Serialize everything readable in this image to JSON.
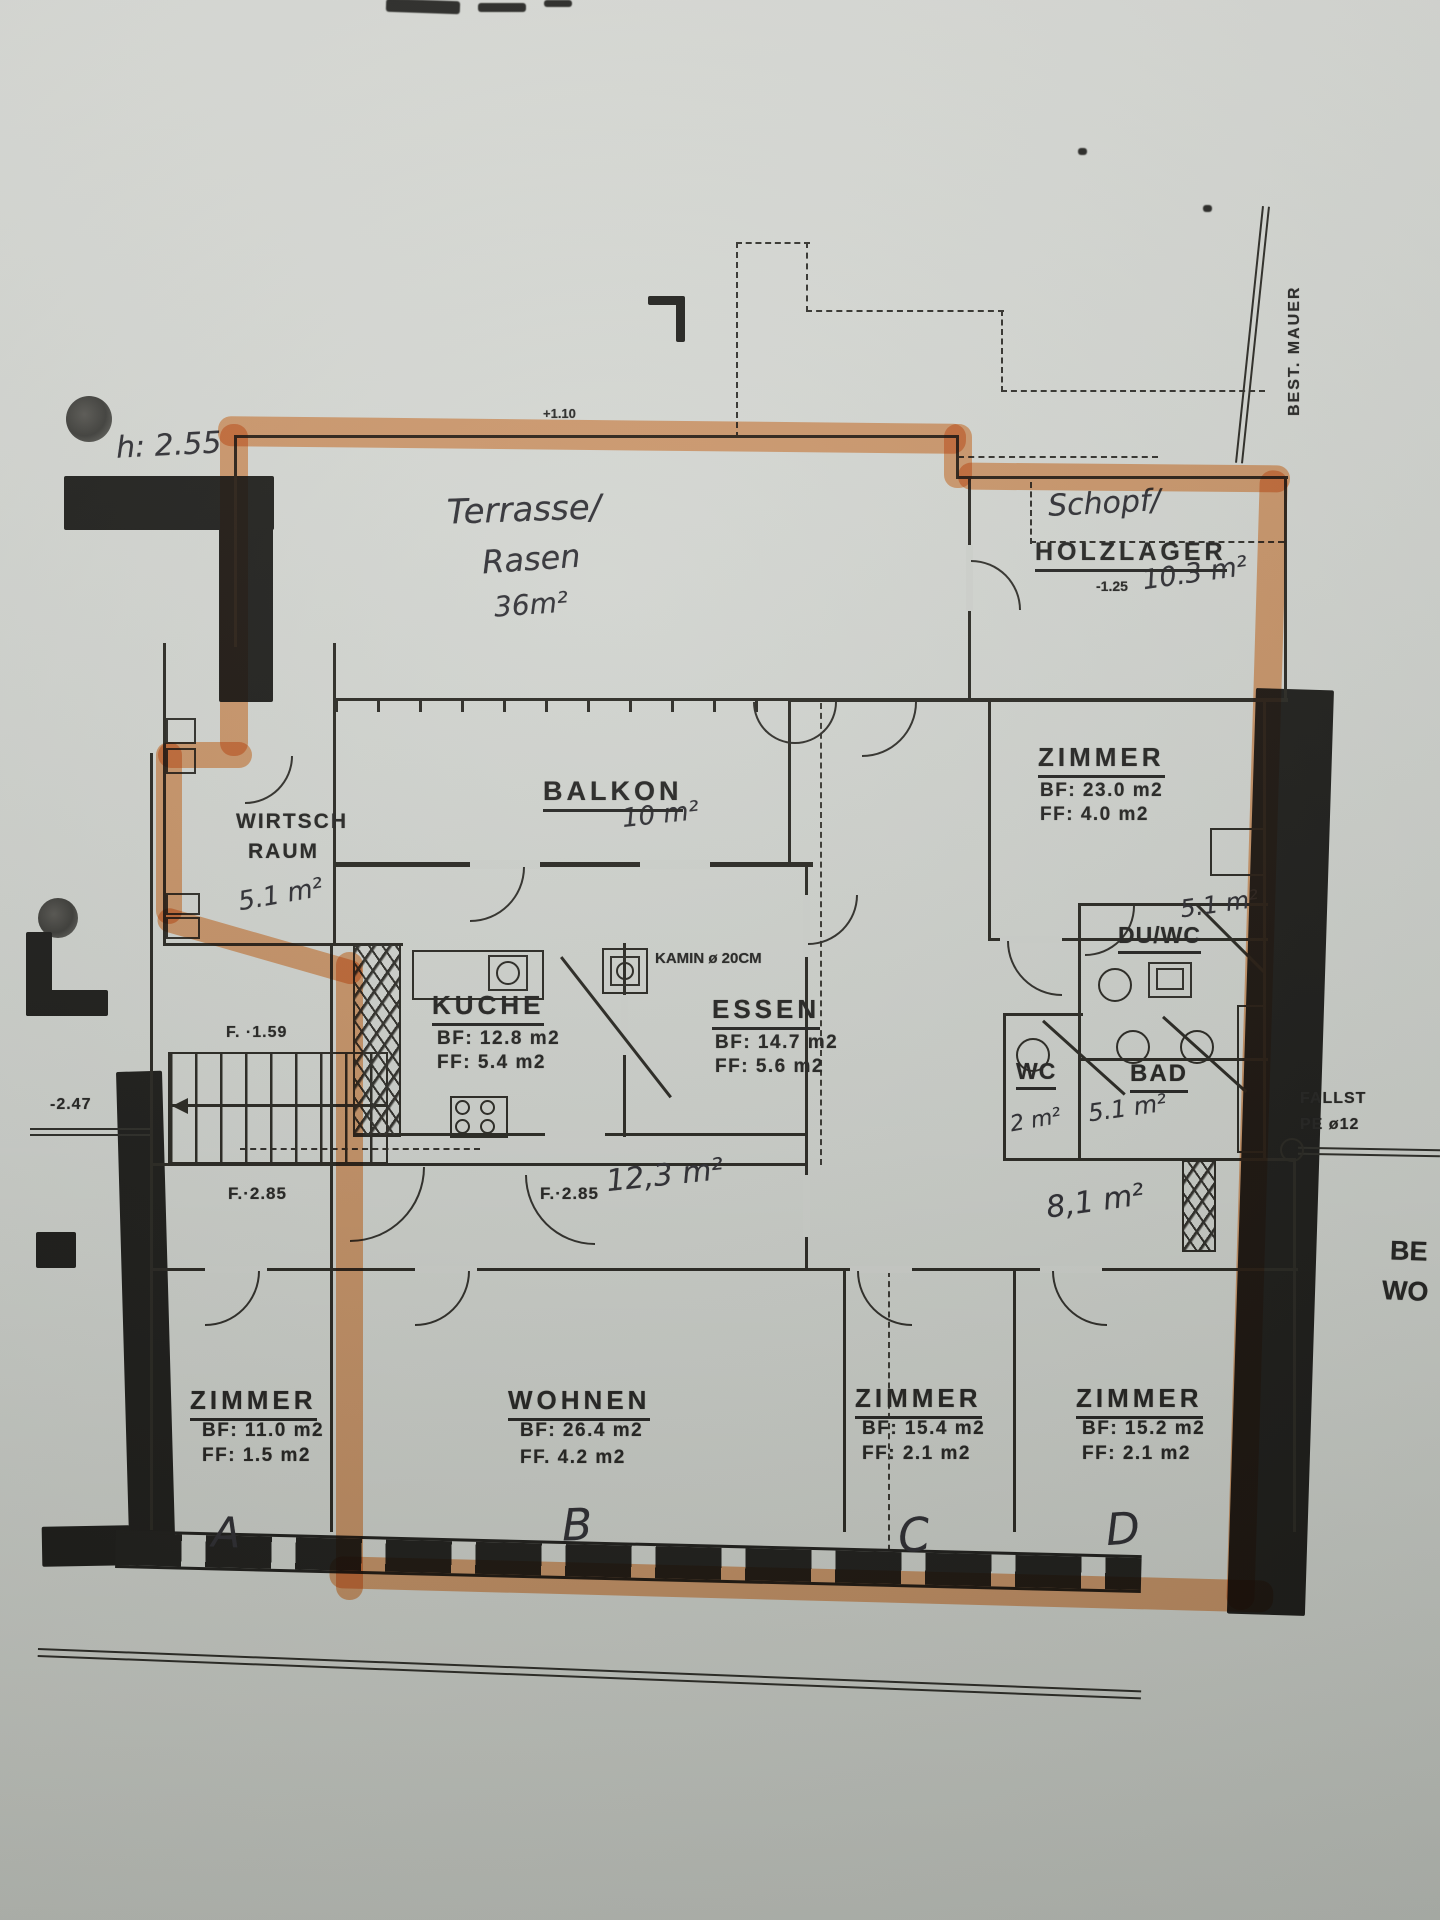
{
  "annotations": {
    "height_note": "h: 2.55",
    "level_top": "+1.10",
    "terrace_1": "Terrasse/",
    "terrace_2": "Rasen",
    "terrace_area": "36m²",
    "schopf": "Schopf/",
    "holzlager": "HOLZLAGER",
    "holzlager_level": "-1.25",
    "holzlager_area": "10.3 m²",
    "best_mauer": "BEST. MAUER",
    "balkon": "BALKON",
    "balkon_area": "10 m²",
    "wirtsch_1": "WIRTSCH",
    "wirtsch_2": "RAUM",
    "wirtsch_area": "5.1 m²",
    "kamin": "KAMIN ø 20CM",
    "level_stair": "F. ·1.59",
    "level_left": "-2.47",
    "f285_left": "F.·2.85",
    "f285_mid": "F.·2.85",
    "hall_area_mid": "12,3 m²",
    "hall_area_right": "8,1 m²",
    "duwc_area": "5.1 m²",
    "wc_area": "2 m²",
    "bad_area": "5.1 m²",
    "fallstrang_1": "FALLST",
    "fallstrang_2": "PE ø12",
    "edge_1": "BE",
    "edge_2": "WO"
  },
  "rooms": {
    "zimmer_ne": {
      "name": "ZIMMER",
      "bf": "BF: 23.0 m2",
      "ff": "FF: 4.0 m2"
    },
    "kueche": {
      "name": "KUCHE",
      "bf": "BF: 12.8 m2",
      "ff": "FF: 5.4 m2"
    },
    "essen": {
      "name": "ESSEN",
      "bf": "BF: 14.7 m2",
      "ff": "FF: 5.6 m2"
    },
    "duwc": {
      "name": "DU/WC"
    },
    "wc": {
      "name": "WC"
    },
    "bad": {
      "name": "BAD"
    },
    "zimmer_a": {
      "name": "ZIMMER",
      "bf": "BF: 11.0 m2",
      "ff": "FF: 1.5 m2",
      "letter": "A"
    },
    "wohnen": {
      "name": "WOHNEN",
      "bf": "BF: 26.4 m2",
      "ff": "FF. 4.2 m2",
      "letter": "B"
    },
    "zimmer_c": {
      "name": "ZIMMER",
      "bf": "BF: 15.4 m2",
      "ff": "FF: 2.1 m2",
      "letter": "C"
    },
    "zimmer_d": {
      "name": "ZIMMER",
      "bf": "BF: 15.2 m2",
      "ff": "FF: 2.1 m2",
      "letter": "D"
    }
  }
}
